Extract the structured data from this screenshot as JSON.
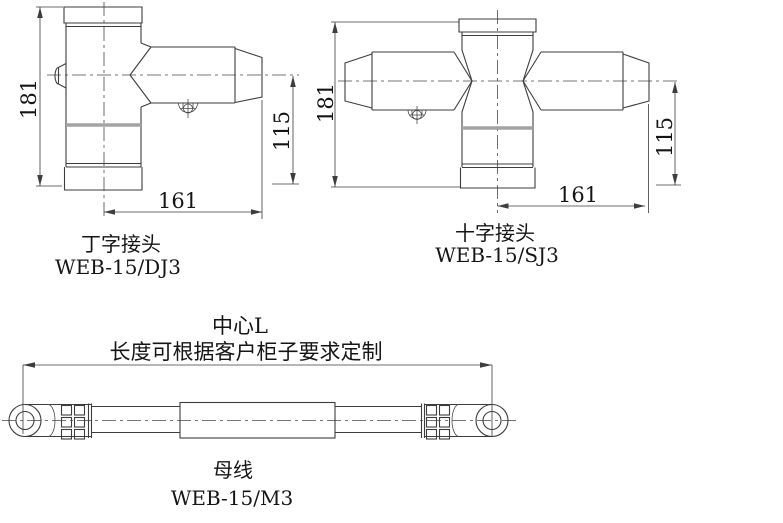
{
  "drawing": {
    "background": "#ffffff",
    "line_color": "#3d3d3d",
    "seam_color": "#a3a3a3",
    "figures": {
      "t_joint": {
        "title": "丁字接头",
        "model": "WEB-15/DJ3",
        "dim_height": "181",
        "dim_length": "161",
        "dim_axis_height": "115"
      },
      "cross_joint": {
        "title": "十字接头",
        "model": "WEB-15/SJ3",
        "dim_height": "181",
        "dim_length": "161",
        "dim_axis_height": "115"
      },
      "busbar": {
        "title": "母线",
        "model": "WEB-15/M3",
        "dim_center_label": "中心L",
        "dim_note": "长度可根据客户柜子要求定制"
      }
    }
  }
}
